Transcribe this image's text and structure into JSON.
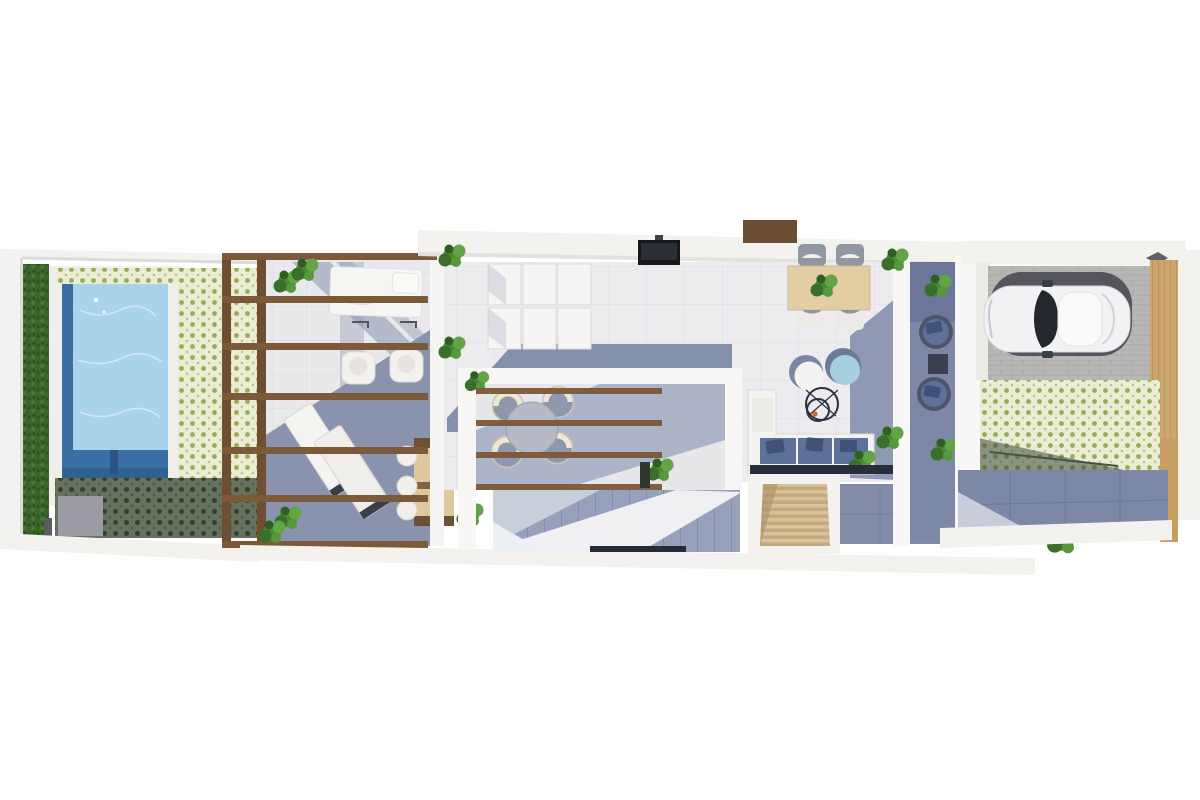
{
  "scene": {
    "kind": "3d-rendered-floor-plan",
    "view": "top-down-axonometric",
    "background": "#ffffff",
    "areas": [
      {
        "id": "pool-garden",
        "objects": [
          "hedge",
          "swimming-pool",
          "pool-deck",
          "green-patterned-tiles",
          "shaded-green-tiles"
        ]
      },
      {
        "id": "pergola-terrace",
        "objects": [
          "wood-beams",
          "daybed",
          "armchair",
          "armchair",
          "sun-lounger",
          "sun-lounger",
          "outdoor-dining-table",
          "dining-chairs",
          "potted-plants"
        ]
      },
      {
        "id": "living-room",
        "objects": [
          "modular-sofa",
          "wall-tv",
          "entry-mat",
          "floor-shadow"
        ]
      },
      {
        "id": "inner-courtyard",
        "objects": [
          "wood-slats",
          "round-table",
          "wicker-chairs",
          "staircase"
        ]
      },
      {
        "id": "dining-lounge",
        "objects": [
          "wood-dining-table",
          "chairs",
          "pouf-white",
          "pouf-blue",
          "wire-coffee-table",
          "corner-sofa",
          "plants",
          "wood-steps"
        ]
      },
      {
        "id": "side-patio",
        "objects": [
          "rattan-chair",
          "rattan-chair",
          "side-table",
          "plants"
        ]
      },
      {
        "id": "garage",
        "objects": [
          "car",
          "paver-driveway",
          "wood-gate"
        ]
      },
      {
        "id": "rear-garden",
        "objects": [
          "green-patterned-tiles",
          "shaded-walkway",
          "wood-post"
        ]
      }
    ]
  },
  "palette": {
    "page_bg": "#ffffff",
    "wall_white": "#f3f2ef",
    "wall_edge": "#d9d8d4",
    "floor_light": "#ecebee",
    "floor_grid": "#dfdee2",
    "shadow_blue": "#8590ac",
    "shadow_blue_dark": "#747fa0",
    "pool_water": "#a9d3ea",
    "pool_edge_dark": "#3a6fa3",
    "pool_floor_dark": "#31618f",
    "hedge_green": "#3b6629",
    "tile_green_bg": "#ebecd4",
    "tile_green_dot": "#96ab55",
    "tile_dark_bg": "#5c6b57",
    "tile_dark_dot": "#35452f",
    "pergola_wood": "#7b5939",
    "table_wood": "#e3cda4",
    "step_wood": "#d9c29a",
    "gate_wood": "#cda56e",
    "plant_green": "#4a8a36",
    "sofa_white": "#f6f5f3",
    "cushion_blue": "#5d719b",
    "pillow_blue": "#3f5379",
    "pouf_blue": "#a8cfe0",
    "stair_base": "#98a1bc",
    "car_body": "#f2f2f4",
    "car_glass": "#23282e",
    "car_shadow": "#54555d",
    "paver_gray": "#b9b7b6",
    "tv_black": "#16181c",
    "door_brown": "#6b4e33",
    "accent_orange": "#d06a28"
  }
}
